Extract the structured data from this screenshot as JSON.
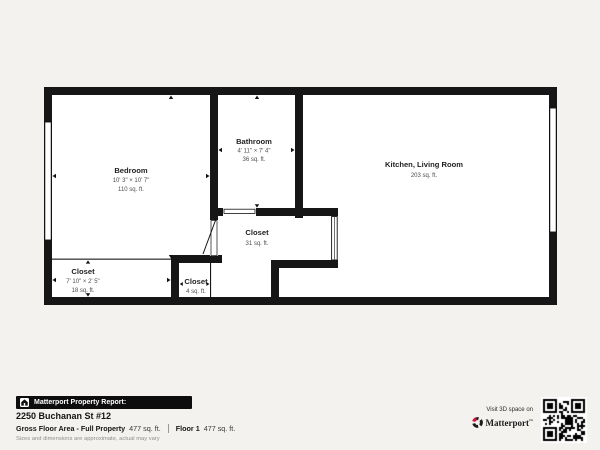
{
  "plan": {
    "wall_color": "#161616",
    "rooms": [
      {
        "name": "Bedroom",
        "dims": "10' 3\" × 10' 7\"",
        "area": "110 sq. ft."
      },
      {
        "name": "Bathroom",
        "dims": "4' 11\" × 7' 4\"",
        "area": "36 sq. ft."
      },
      {
        "name": "Kitchen, Living Room",
        "area": "203 sq. ft."
      },
      {
        "name": "Closet",
        "area": "31 sq. ft."
      },
      {
        "name": "Closet",
        "dims": "7' 10\" × 2' 5\"",
        "area": "18 sq. ft."
      },
      {
        "name": "Closet",
        "area": "4 sq. ft."
      }
    ]
  },
  "footer": {
    "report_badge": "Matterport Property Report:",
    "address": "2250 Buchanan St #12",
    "gross_label": "Gross Floor Area - Full Property",
    "gross_value": "477 sq. ft.",
    "floor_label": "Floor 1",
    "floor_value": "477 sq. ft.",
    "disclaimer": "Sizes and dimensions are approximate, actual may vary",
    "visit_text": "Visit 3D space on",
    "brand": "Matterport",
    "brand_trademark": "™",
    "accent_red": "#d0103a",
    "icons": {
      "badge": "house-icon",
      "logo": "matterport-logo",
      "code": "qr-code"
    }
  }
}
